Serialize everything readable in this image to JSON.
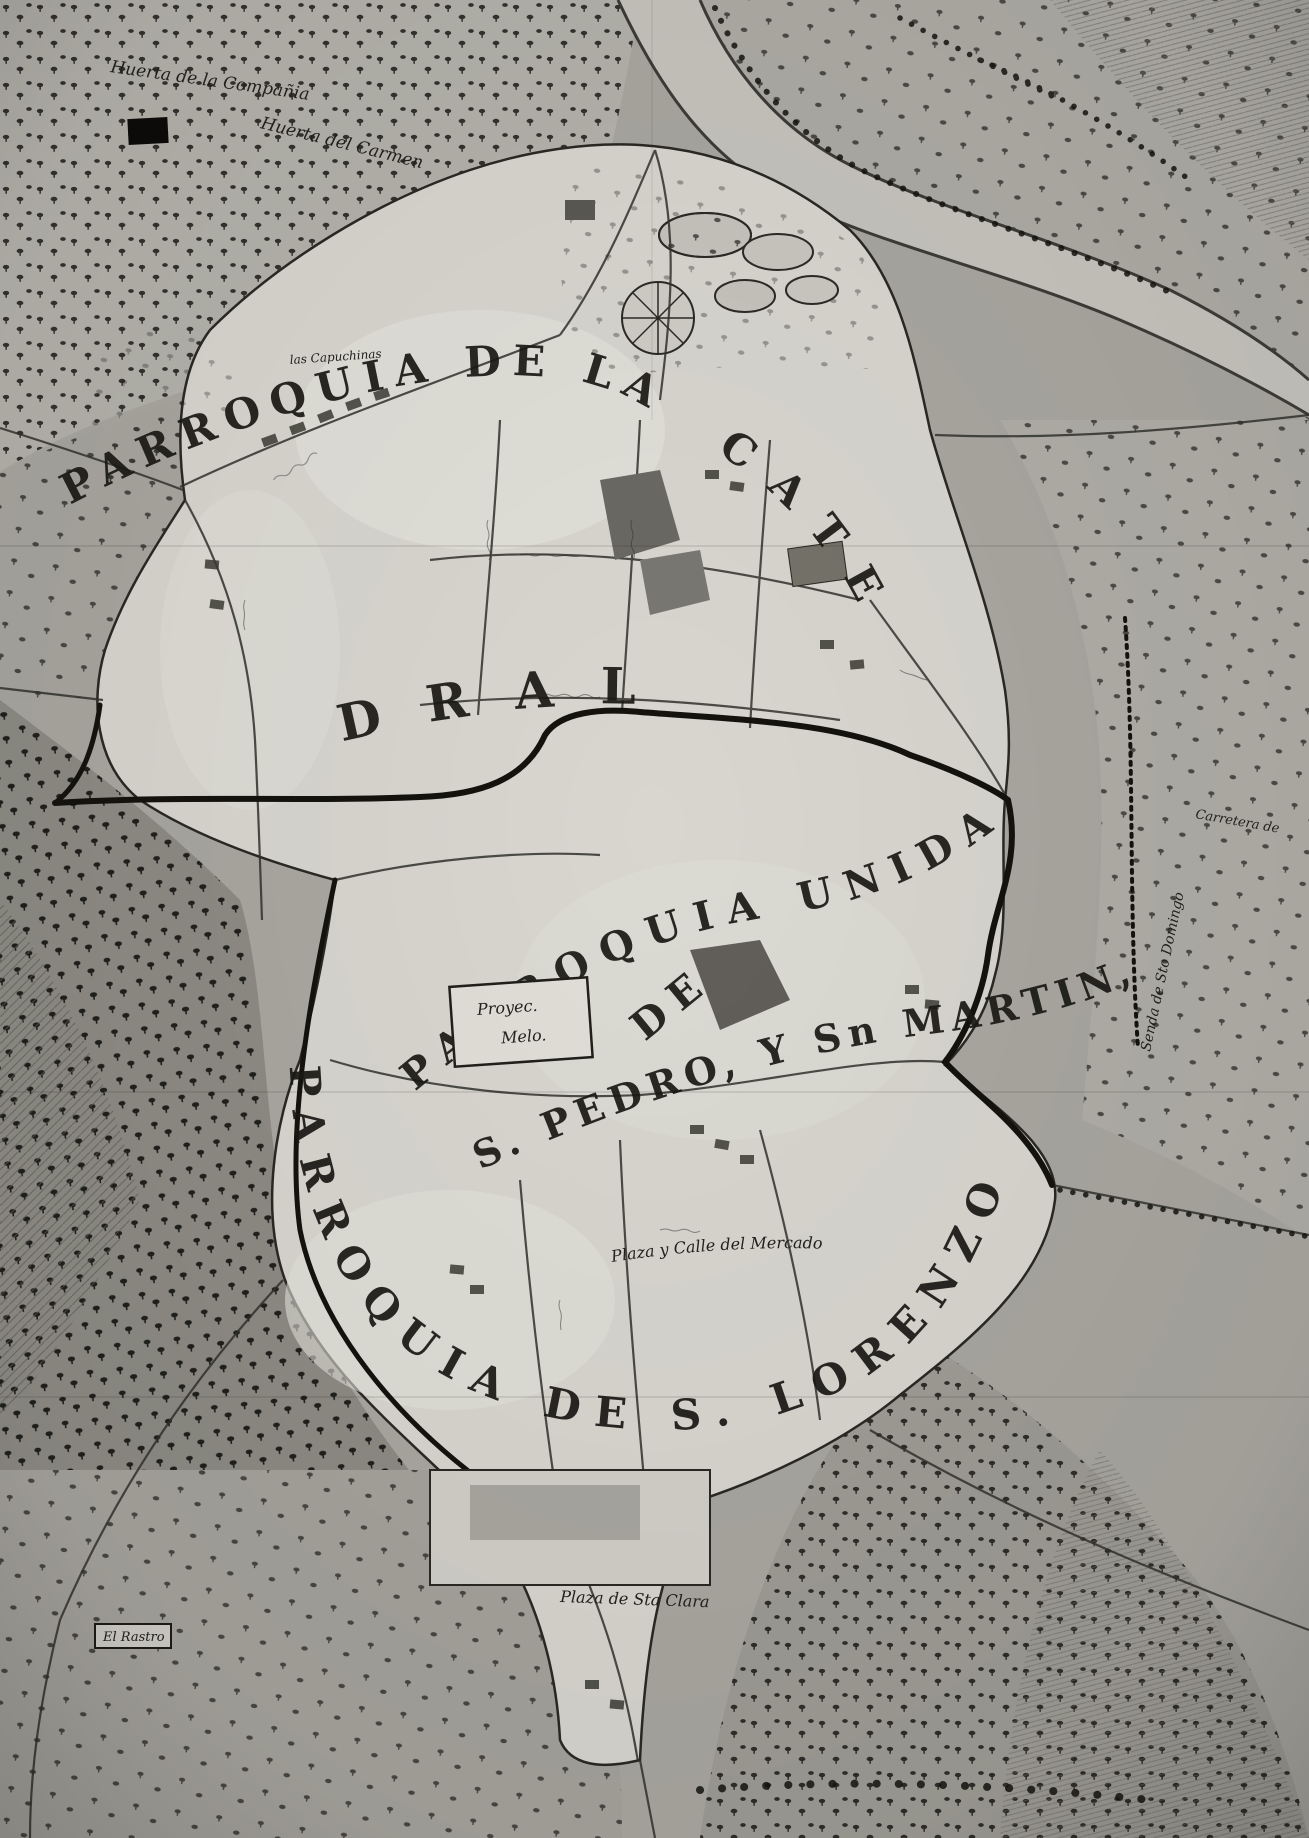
{
  "map": {
    "parishes": {
      "catedral_arc": "PARROQUIA DE LA",
      "catedral_tail": "CATE",
      "catedral_middle": "DRAL",
      "unida_arc": "PARROQUIA UNIDA",
      "unida_de": "DE",
      "unida_saints": "S. PEDRO, Y Sn MARTIN,",
      "lorenzo_arc": "PARROQUIA DE S. LORENZO"
    },
    "places": {
      "huerta_compania": "Huerta de la Compañia",
      "huerta_carmen": "Huerta del Carmen",
      "capuchinas": "las Capuchinas",
      "proyecto_line1": "Proyec.",
      "proyecto_line2": "Melo.",
      "plaza_calle_mercado": "Plaza y Calle del Mercado",
      "plaza_sta_clara": "Plaza de Sta Clara",
      "el_rastro": "El Rastro",
      "senda_sto_domingo": "Senda de Sto Domingo",
      "carretera": "Carretera de"
    }
  }
}
